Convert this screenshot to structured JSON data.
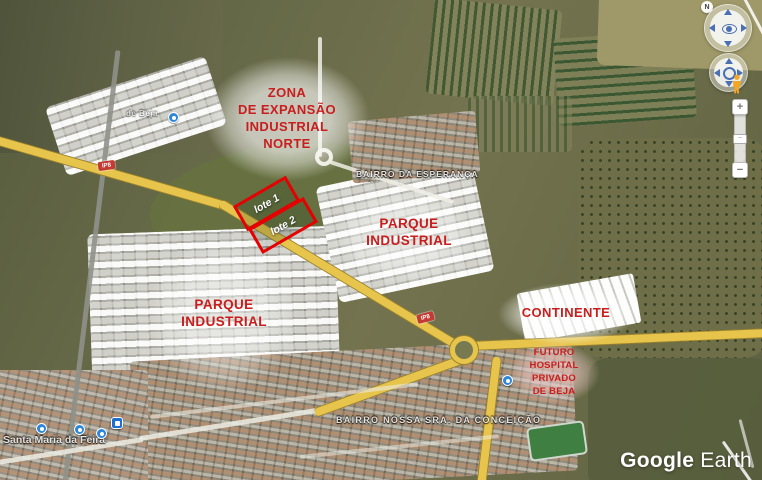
{
  "app": {
    "brand": "Google",
    "product": "Earth"
  },
  "annotations": {
    "color": "#c81e1e",
    "zona_expansao": "ZONA\nDE EXPANSÃO\nINDUSTRIAL\nNORTE",
    "parque_industrial_right": "PARQUE\nINDUSTRIAL",
    "parque_industrial_left": "PARQUE\nINDUSTRIAL",
    "continente": "CONTINENTE",
    "futuro_hospital": "FUTURO\nHOSPITAL\nPRIVADO\nDE BEJA",
    "lots": {
      "outline_color": "#e60000",
      "lote_1": "lote 1",
      "lote_2": "lote 2"
    }
  },
  "place_labels": {
    "bairro_esperanca": "BAIRRO DA ESPERANÇA",
    "bairro_conceicao": "BAIRRO NOSSA SRA. DA CONCEIÇÃO",
    "santa_maria_da_feira": "Santa Maria da Feira",
    "beja_fragment": "de Beja"
  },
  "road_shields": [
    {
      "label": "IP8"
    },
    {
      "label": "IP8"
    }
  ],
  "controls": {
    "north_label": "N",
    "zoom_in_label": "+",
    "zoom_out_label": "−",
    "slider_handle_label": "−",
    "icons": {
      "look_joystick": "eye-center-joystick",
      "move_joystick": "ring-center-joystick",
      "pegman": "street-view-person",
      "zoom_slider": "vertical-zoom-slider"
    }
  },
  "colors": {
    "road_yellow": "#e7c44c",
    "poi_blue": "#2e86d9",
    "label_white": "#ffffff"
  }
}
